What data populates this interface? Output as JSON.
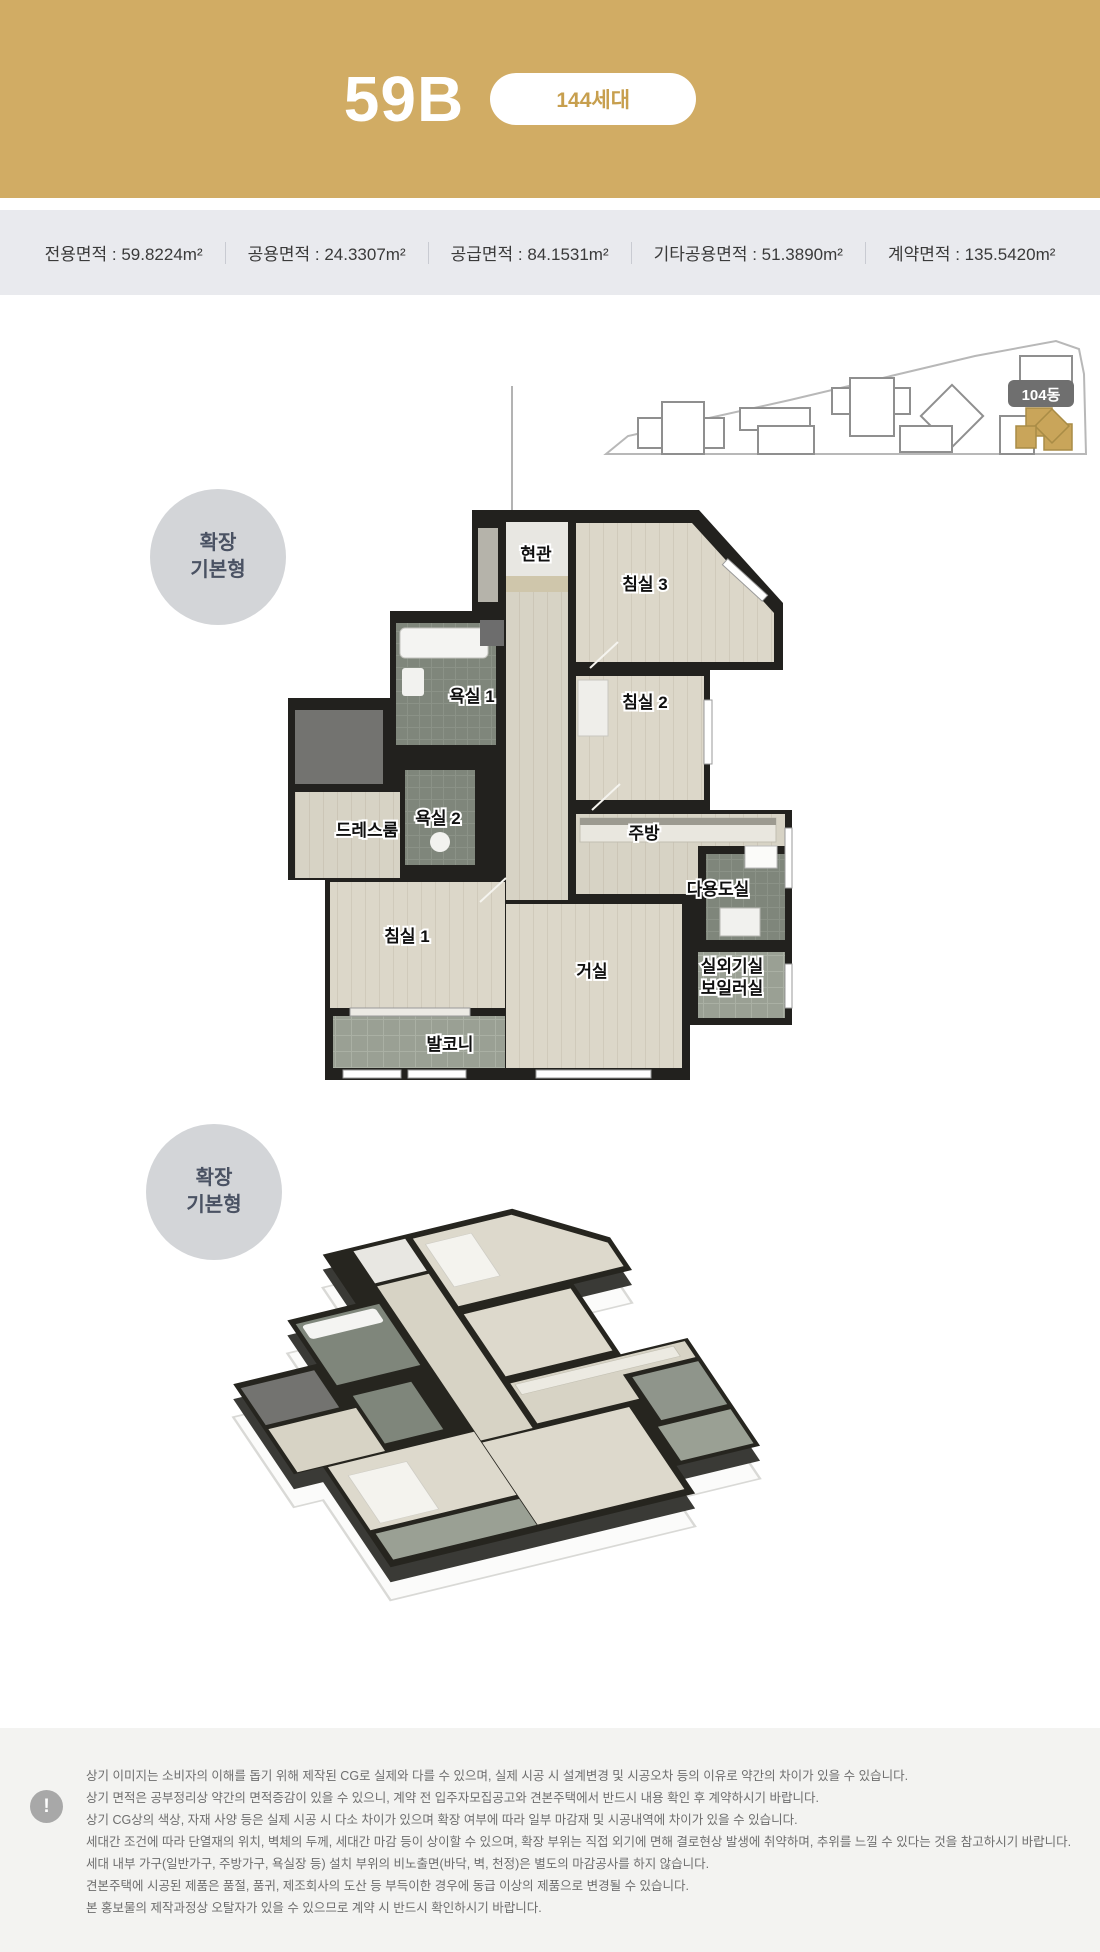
{
  "header": {
    "unit_type": "59B",
    "household_badge": "144세대"
  },
  "specs": {
    "colon": " : ",
    "items": [
      {
        "label": "전용면적",
        "value": "59.8224m²"
      },
      {
        "label": "공용면적",
        "value": "24.3307m²"
      },
      {
        "label": "공급면적",
        "value": "84.1531m²"
      },
      {
        "label": "기타공용면적",
        "value": "51.3890m²"
      },
      {
        "label": "계약면적",
        "value": "135.5420m²"
      }
    ]
  },
  "site_plan": {
    "building_label": "104동",
    "highlight_color": "#c9a55a"
  },
  "plan_badge": {
    "line1": "확장",
    "line2": "기본형"
  },
  "rooms": {
    "entrance": "현관",
    "bedroom3": "침실 3",
    "bathroom1": "욕실 1",
    "bedroom2": "침실 2",
    "bathroom2": "욕실 2",
    "dressroom": "드레스룸",
    "kitchen": "주방",
    "utility": "다용도실",
    "bedroom1": "침실 1",
    "living": "거실",
    "outdoor_unit": "실외기실",
    "boiler": "보일러실",
    "balcony": "발코니"
  },
  "footer": {
    "icon": "!",
    "lines": [
      "상기 이미지는 소비자의 이해를 돕기 위해 제작된 CG로 실제와 다를 수 있으며, 실제 시공 시 설계변경 및 시공오차 등의 이유로 약간의 차이가 있을 수 있습니다.",
      "상기 면적은 공부정리상 약간의 면적증감이 있을 수 있으니, 계약 전 입주자모집공고와 견본주택에서 반드시 내용 확인 후 계약하시기 바랍니다.",
      "상기 CG상의 색상, 자재 사양 등은 실제 시공 시 다소 차이가 있으며 확장 여부에 따라 일부 마감재 및 시공내역에 차이가 있을 수 있습니다.",
      "세대간 조건에 따라 단열재의 위치, 벽체의 두께, 세대간 마감 등이 상이할 수 있으며, 확장 부위는 직접 외기에 면해 결로현상 발생에 취약하며, 추위를 느낄 수 있다는 것을 참고하시기 바랍니다.",
      "세대 내부 가구(일반가구, 주방가구, 욕실장 등) 설치 부위의 비노출면(바닥, 벽, 천정)은 별도의 마감공사를 하지 않습니다.",
      "견본주택에 시공된 제품은 품절, 품귀, 제조회사의 도산 등 부득이한 경우에 동급 이상의 제품으로 변경될 수 있습니다.",
      "본 홍보물의 제작과정상 오탈자가 있을 수 있으므로 계약 시 반드시 확인하시기 바랍니다."
    ]
  },
  "colors": {
    "header_gold": "#d1ac64",
    "specs_bg": "#e9eaee",
    "plan_wall": "#22211e",
    "footer_bg": "#f3f3f1"
  }
}
